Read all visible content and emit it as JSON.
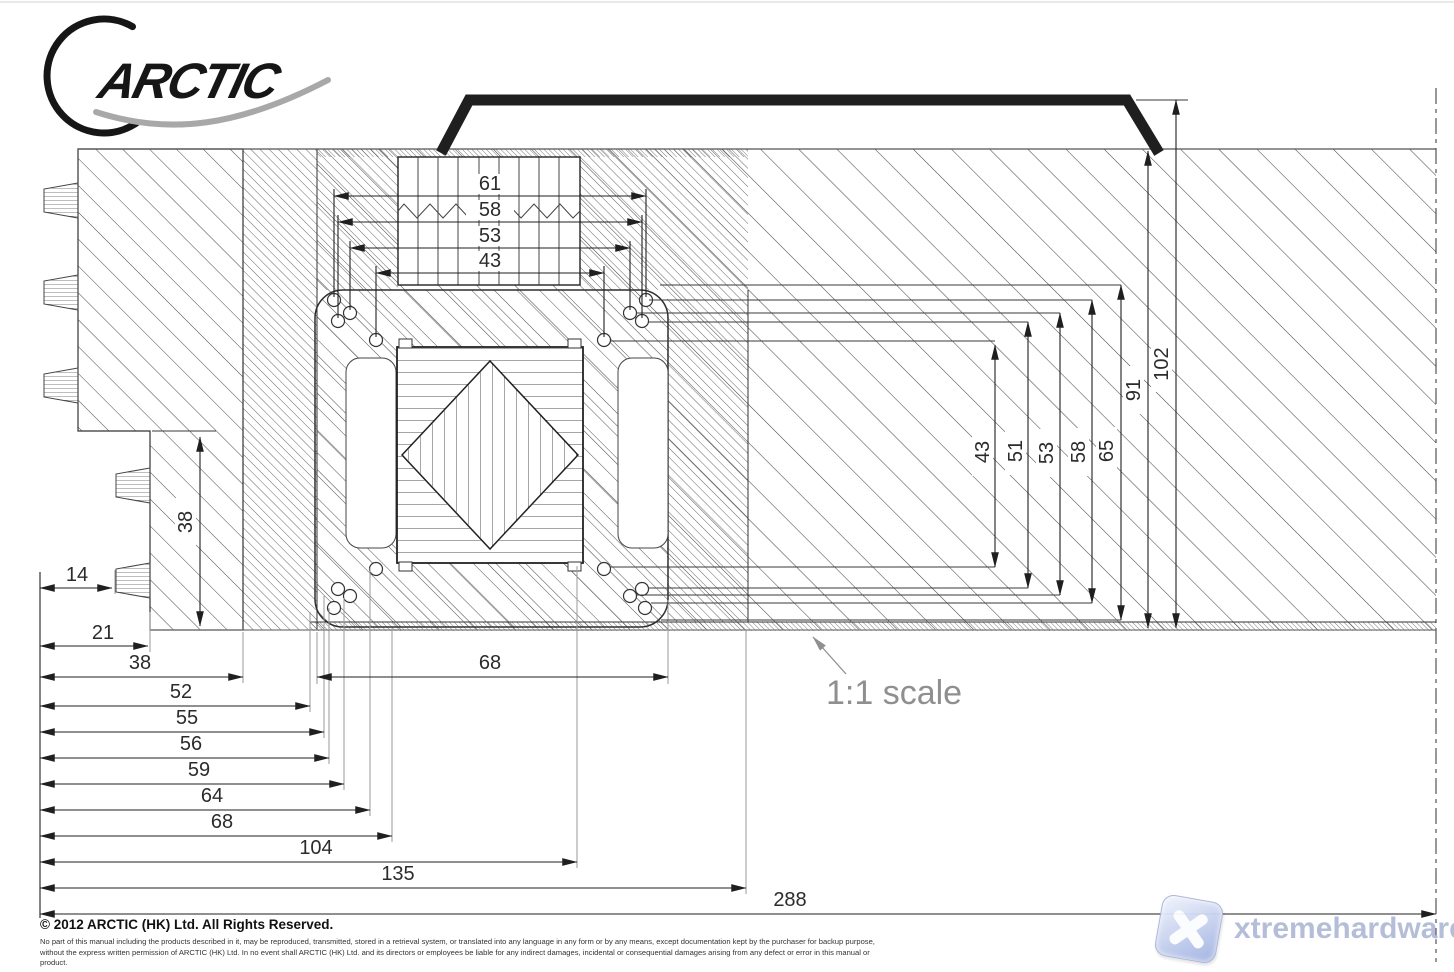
{
  "logo": {
    "brand": "ARCTIC"
  },
  "drawing": {
    "scale_note": "1:1 scale",
    "dimensions": {
      "top": [
        "61",
        "58",
        "53",
        "43"
      ],
      "right": [
        "43",
        "51",
        "53",
        "58",
        "65",
        "91",
        "102"
      ],
      "left": [
        "38"
      ],
      "middle": [
        "68"
      ],
      "bottom": [
        "14",
        "21",
        "38",
        "52",
        "55",
        "56",
        "59",
        "64",
        "68",
        "104",
        "135",
        "288"
      ]
    }
  },
  "footer": {
    "copyright": "© 2012 ARCTIC (HK) Ltd. All Rights Reserved.",
    "legal": "No part of this manual including the products described in it, may be reproduced, transmitted, stored in a retrieval system, or translated into any language in any form or by any means, except documentation kept by the purchaser for backup purpose, without the express written permission of ARCTIC (HK) Ltd. In no event shall ARCTIC (HK) Ltd. and its directors or employees be liable for any indirect damages, incidental or consequential damages arising from any defect or error in this manual or product."
  },
  "watermark": {
    "site": "xtremehardware.com"
  },
  "colors": {
    "line_dark": "#2a2a2a",
    "extension_gray": "#9a9a9a",
    "note_gray": "#8f8f8f",
    "watermark_blue": "#b2bbd8"
  }
}
